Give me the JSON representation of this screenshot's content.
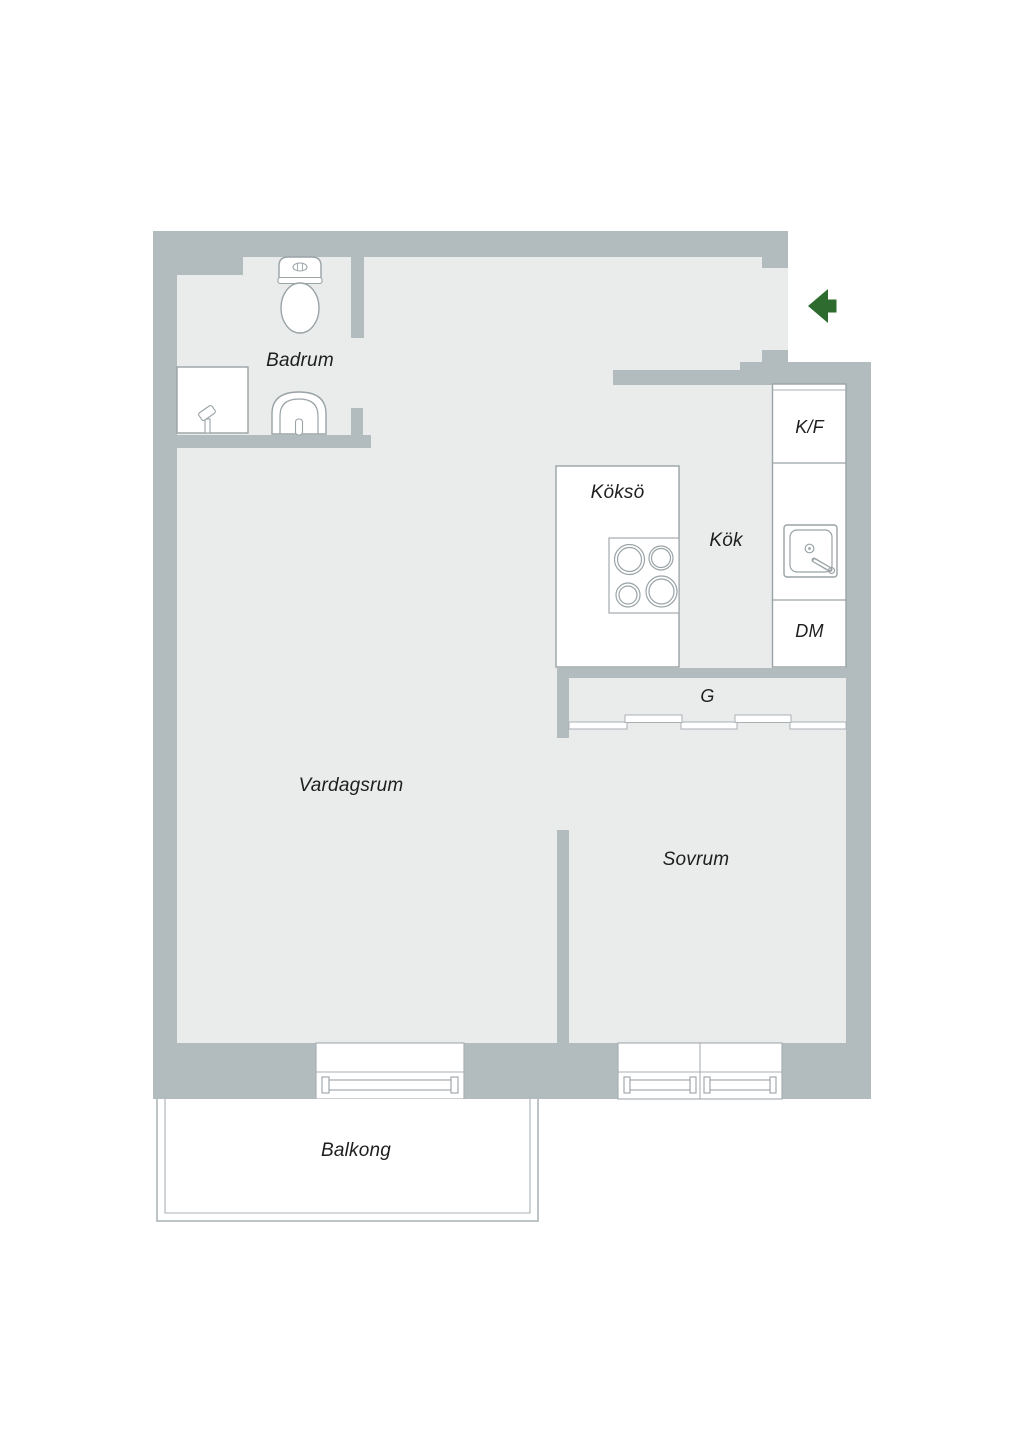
{
  "title": "Apartment floor plan",
  "colors": {
    "wall": "#b2bbbe",
    "floor": "#eaebeb",
    "line": "#9aa3a6",
    "line2": "#a9b1b4",
    "text": "#1e1e1e",
    "accent": "#2e6b2f",
    "white": "#ffffff"
  },
  "rooms": {
    "badrum": {
      "label": "Badrum"
    },
    "kokso": {
      "label": "Köksö"
    },
    "kok": {
      "label": "Kök"
    },
    "vardagsrum": {
      "label": "Vardagsrum"
    },
    "sovrum": {
      "label": "Sovrum"
    },
    "balkong": {
      "label": "Balkong"
    },
    "garderob": {
      "label": "G"
    }
  },
  "appliances": {
    "fridge_freezer": {
      "label": "K/F"
    },
    "dishwasher": {
      "label": "DM"
    }
  },
  "icons": {
    "entrance": "entrance-arrow-left",
    "toilet": "toilet-icon",
    "bath_sink": "sink-icon",
    "shower": "shower-icon",
    "stove": "cooktop-icon",
    "kitchen_sink": "kitchen-sink-icon",
    "wardrobe_doors": "sliding-doors",
    "windows": "window-symbol"
  }
}
